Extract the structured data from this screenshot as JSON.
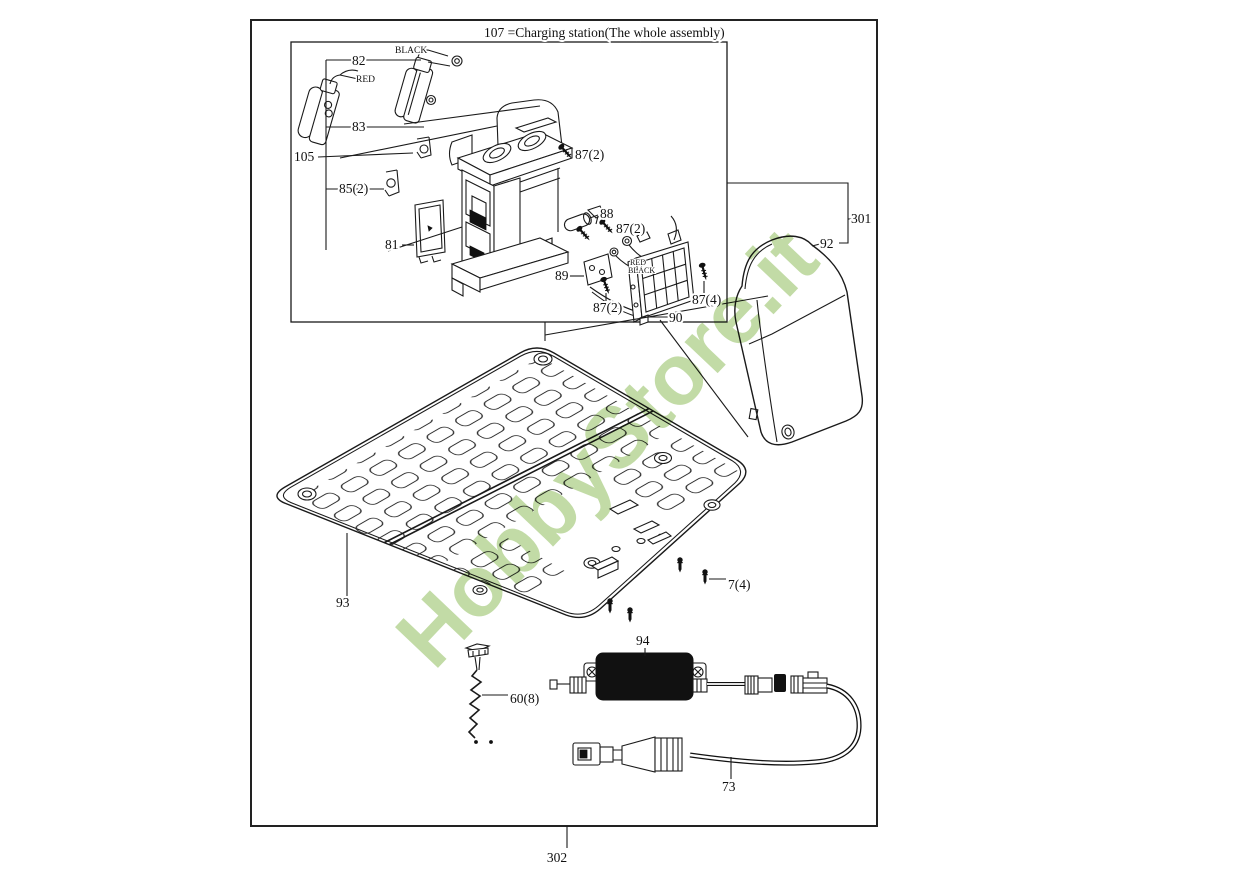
{
  "watermark": {
    "text": "HobbyStore.it",
    "color": "#b5d392",
    "opacity": 0.82,
    "rotation_deg": -46.5
  },
  "diagram": {
    "title": "107  =Charging station(The whole assembly)",
    "labels": [
      {
        "id": "part-82",
        "text": "82"
      },
      {
        "id": "wire-black-top",
        "text": "BLACK"
      },
      {
        "id": "wire-red-top",
        "text": "RED"
      },
      {
        "id": "part-83",
        "text": "83"
      },
      {
        "id": "part-105",
        "text": "105"
      },
      {
        "id": "part-85-2",
        "text": "85(2)"
      },
      {
        "id": "part-81",
        "text": "81"
      },
      {
        "id": "part-87-2-top",
        "text": "87(2)"
      },
      {
        "id": "part-88",
        "text": "88"
      },
      {
        "id": "part-87-2-mid",
        "text": "87(2)"
      },
      {
        "id": "part-89",
        "text": "89"
      },
      {
        "id": "wire-red-small",
        "text": "RED"
      },
      {
        "id": "wire-black-small",
        "text": "BLACK"
      },
      {
        "id": "part-87-2-bottom",
        "text": "87(2)"
      },
      {
        "id": "part-90",
        "text": "90"
      },
      {
        "id": "part-87-4",
        "text": "87(4)"
      },
      {
        "id": "assembly-301",
        "text": "301"
      },
      {
        "id": "part-92",
        "text": "92"
      },
      {
        "id": "part-93",
        "text": "93"
      },
      {
        "id": "part-7-4",
        "text": "7(4)"
      },
      {
        "id": "part-94",
        "text": "94"
      },
      {
        "id": "part-60-8",
        "text": "60(8)"
      },
      {
        "id": "part-73",
        "text": "73"
      },
      {
        "id": "assembly-302",
        "text": "302"
      }
    ]
  }
}
